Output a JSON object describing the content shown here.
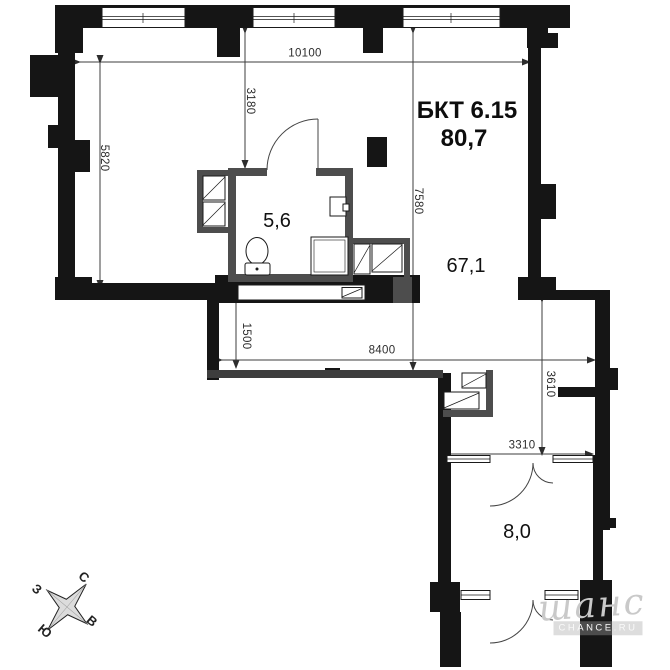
{
  "plan": {
    "unit_label": "БКТ 6.15",
    "total_area": "80,7",
    "rooms": [
      {
        "name": "bathroom",
        "area": "5,6"
      },
      {
        "name": "living-space",
        "area": "67,1"
      },
      {
        "name": "lower-room",
        "area": "8,0"
      }
    ],
    "dimensions_mm": {
      "top_width": "10100",
      "left_height": "5820",
      "window_to_bath": "3180",
      "right_height": "7580",
      "closet_depth": "1500",
      "corridor_width": "8400",
      "shaft_height": "3610",
      "lower_room_width": "3310"
    }
  },
  "compass": {
    "north": "С",
    "east": "В",
    "south": "Ю",
    "west": "З"
  },
  "watermark": {
    "script": "шанс",
    "badge": "CHANCE.RU"
  },
  "colors": {
    "wall": "#151515",
    "partition": "#4d4d4d",
    "dimension": "#2d2d2d",
    "watermark": "#c9c9c9"
  }
}
